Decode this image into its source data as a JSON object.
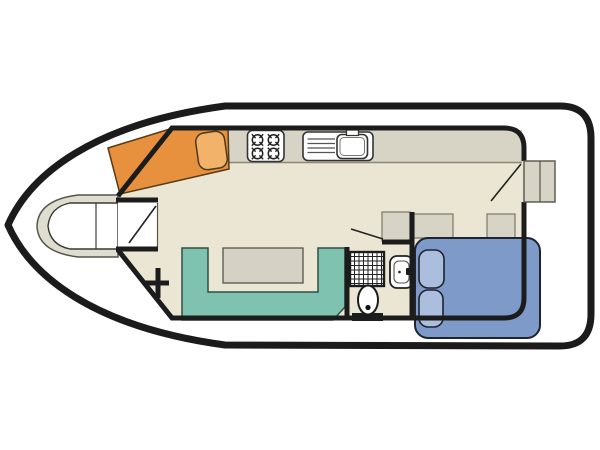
{
  "diagram": {
    "type": "houseboat-floor-plan",
    "rooms": [
      "bow-cabin",
      "saloon",
      "galley",
      "bathroom",
      "aft-cabin"
    ],
    "fixtures": [
      "v-berth",
      "bow-locker-door",
      "dinette-seat",
      "dinette-table",
      "cooktop-4-burner",
      "sink-with-drainboard",
      "u-shaped-sofa",
      "saloon-table",
      "mast-foot",
      "shower",
      "toilet",
      "washbasin",
      "storage-cabinets",
      "double-bed",
      "pillows",
      "entry-door-with-steps"
    ]
  },
  "colors": {
    "white": "#ffffff",
    "hull_stroke": "#1b1b1b",
    "wall": "#1c1c1c",
    "floor": "#eae6d3",
    "counter": "#d7d4c5",
    "berth_surround": "#dfddcf",
    "dinette_orange": "#e7913e",
    "dinette_table": "#f2b269",
    "sofa_teal": "#7fc2b0",
    "saloon_table": "#d5d2c5",
    "bed_blue": "#7e9ac8",
    "pillow_blue": "#abbedd"
  }
}
